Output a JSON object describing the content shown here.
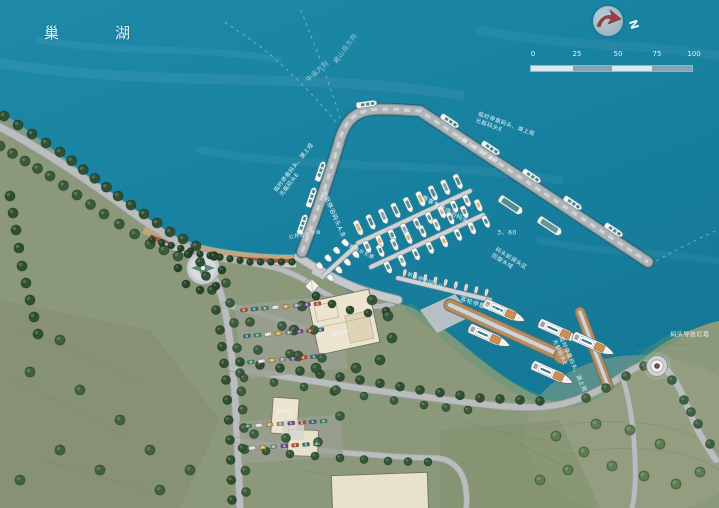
{
  "map": {
    "lake_name": "巢湖",
    "route_labels": {
      "laoshan": "姥山岛方向",
      "zhongmiao": "中庙方向"
    },
    "compass_letter": "N",
    "scale_ticks": [
      "0",
      "25",
      "50",
      "75",
      "100"
    ],
    "depth_marker": "3、60",
    "pier_labels": {
      "temp": {
        "line1": "临时停靠码头、湖上观",
        "line2": "光艇码头E"
      },
      "breakwater": "水面上浮动防波堤",
      "marina": "游艇停泊码头A.B",
      "race": "赛事专用停泊码头C",
      "dinghy": "帆船停泊码头D",
      "ferry": "客轮停靠码头A",
      "turning": {
        "line1": "码头前调头区",
        "line2": "回旋水域"
      }
    },
    "site_labels": {
      "platform": "公共活动平台",
      "promenade": "景观亲水长廊",
      "clubhouse": "游艇会所",
      "service": "服务用房",
      "lighthouse": "码头导航灯塔"
    },
    "colors": {
      "water": "#17809f",
      "land": "#8c987a",
      "pier_tan": "#b08e66",
      "compass_red": "#9c4042"
    }
  }
}
